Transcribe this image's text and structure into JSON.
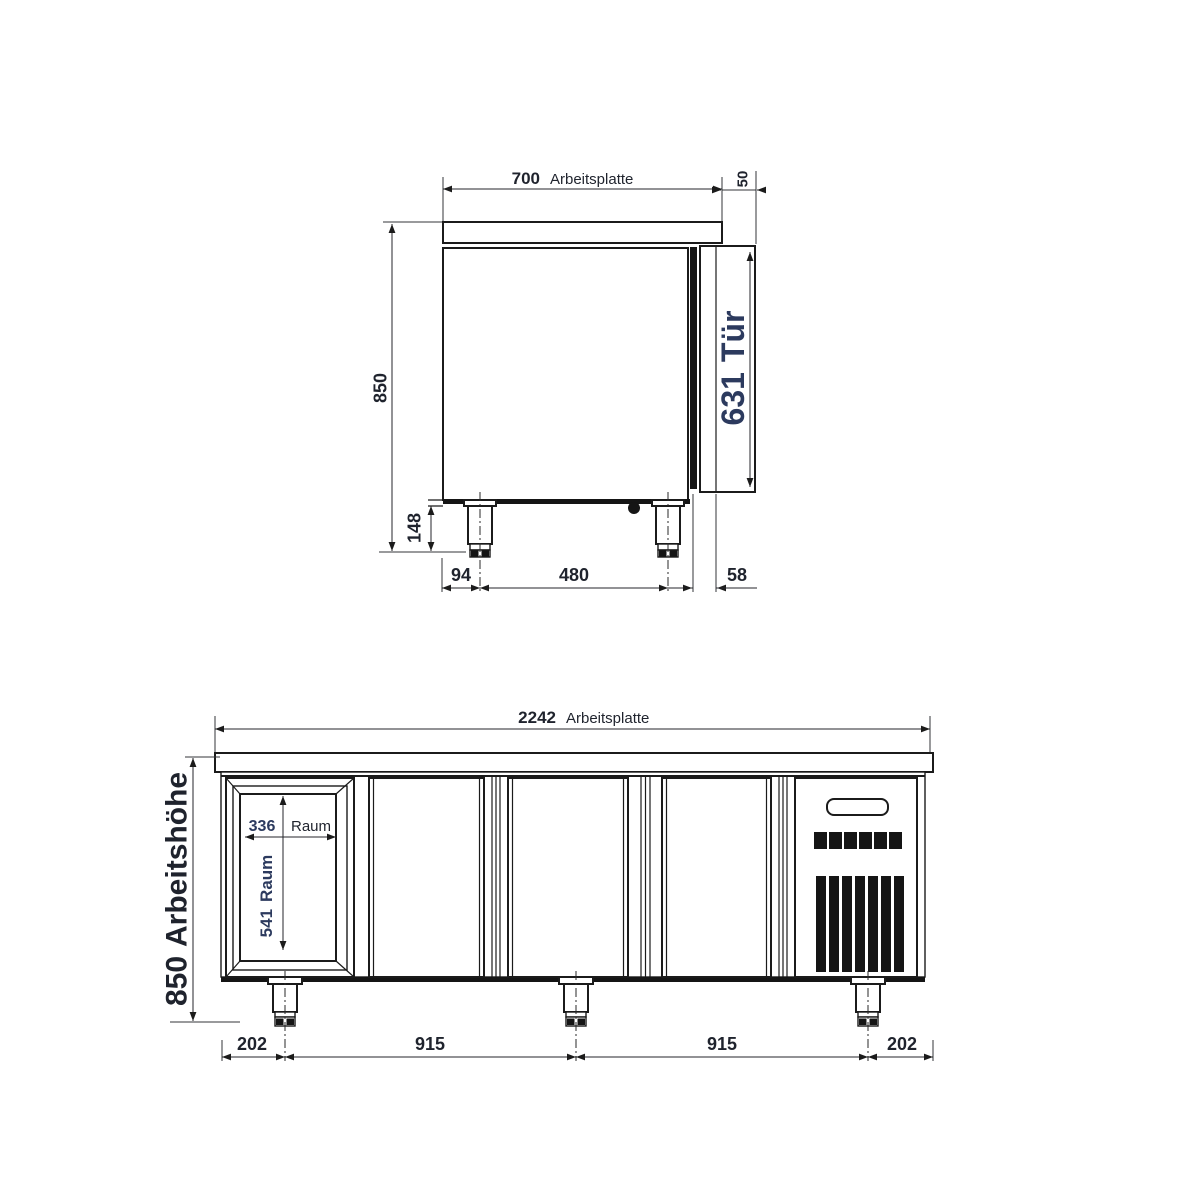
{
  "colors": {
    "line": "#1b1b1b",
    "dim_text": "#1f232d",
    "accent_blue": "#2c3a5e",
    "background": "#ffffff"
  },
  "side_view": {
    "width_value": "700",
    "width_label": "Arbeitsplatte",
    "worktop_thickness": "50",
    "overall_height": "850",
    "leg_height": "148",
    "door_value": "631",
    "door_label": "Tür",
    "front_offset": "94",
    "leg_spacing": "480",
    "rear_offset": "58"
  },
  "front_view": {
    "width_value": "2242",
    "width_label": "Arbeitsplatte",
    "height_value": "850",
    "height_label": "Arbeitshöhe",
    "compartment_width_value": "336",
    "compartment_width_label": "Raum",
    "compartment_height_value": "541",
    "compartment_height_label": "Raum",
    "bottom_left": "202",
    "span_left": "915",
    "span_right": "915",
    "bottom_right": "202"
  }
}
